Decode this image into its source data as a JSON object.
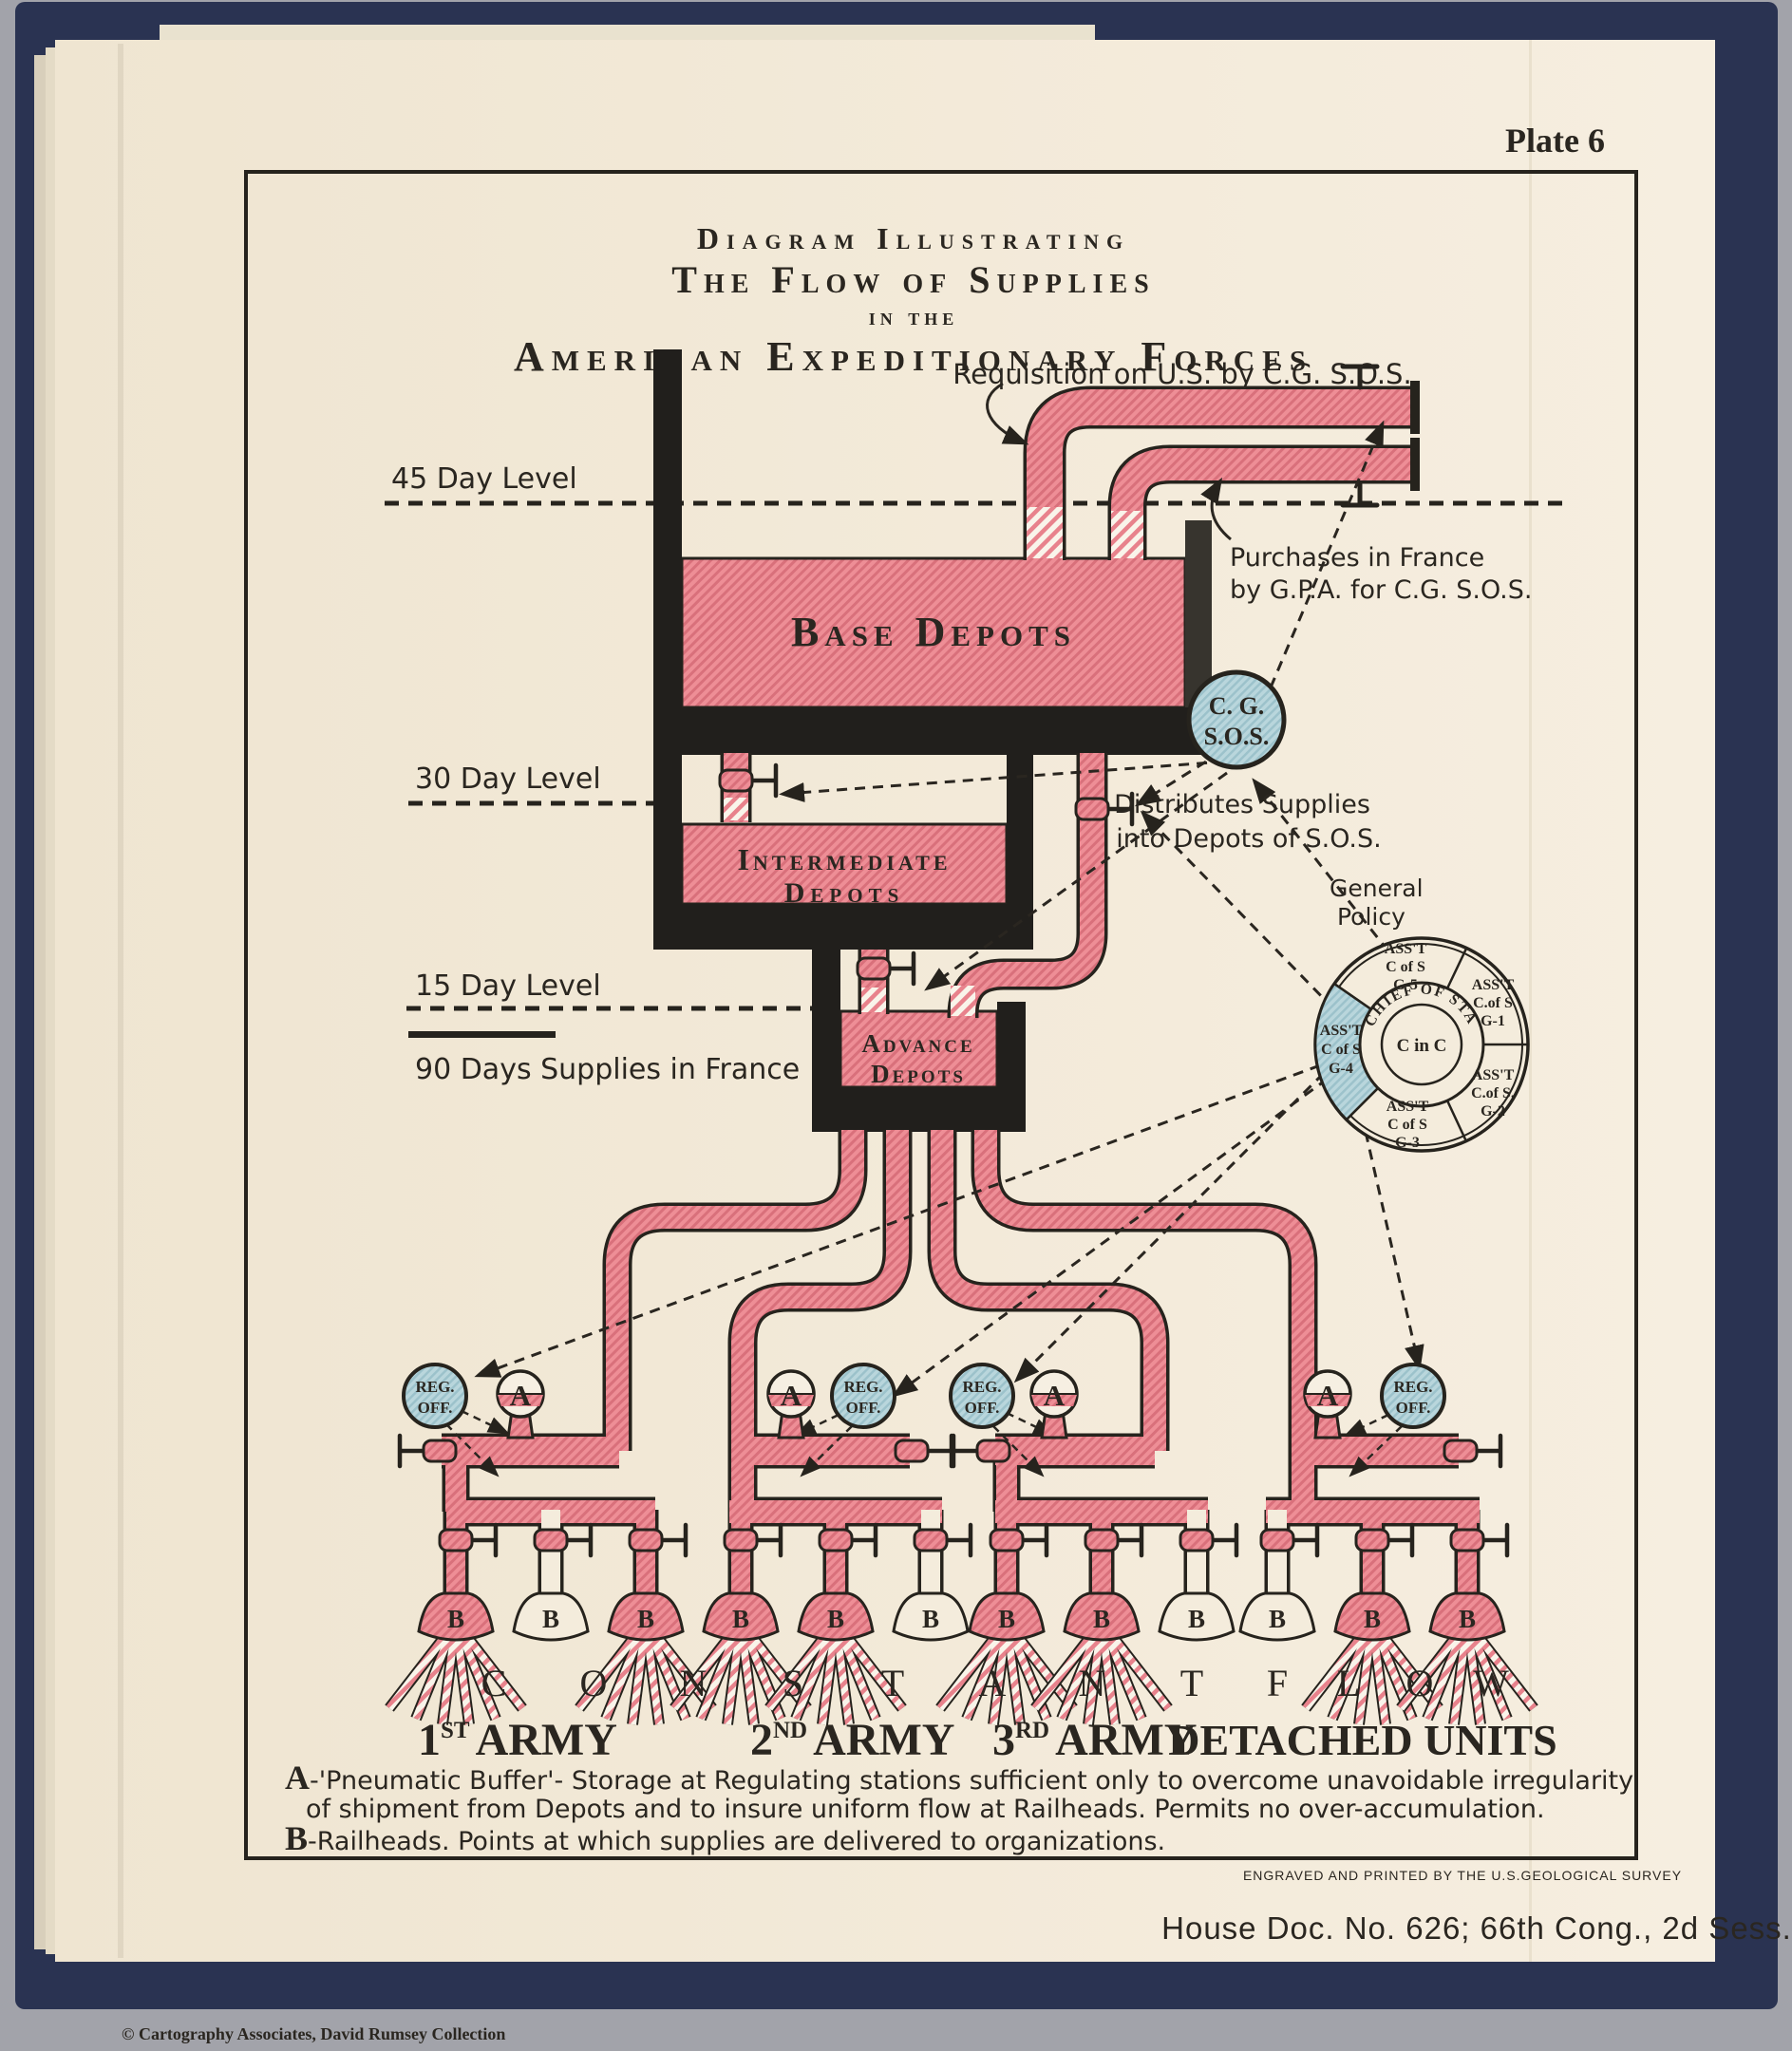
{
  "plate": "Plate 6",
  "title": {
    "line1": "Diagram Illustrating",
    "line2": "The Flow of Supplies",
    "line3": "in the",
    "line4": "American Expeditionary Forces"
  },
  "annotations": {
    "requisition": "Requisition on U.S. by C.G. S.O.S.",
    "purchases_line1": "Purchases in France",
    "purchases_line2": "by G.P.A. for C.G. S.O.S.",
    "level_45": "45 Day Level",
    "level_30": "30 Day Level",
    "level_15": "15 Day Level",
    "supplies_total": "90 Days Supplies in France",
    "distributes_line1": "Distributes Supplies",
    "distributes_line2": "into Depots of S.O.S.",
    "general_policy_line1": "General",
    "general_policy_line2": "Policy"
  },
  "tanks": {
    "base": "Base Depots",
    "intermediate_line1": "Intermediate",
    "intermediate_line2": "Depots",
    "advance_line1": "Advance",
    "advance_line2": "Depots"
  },
  "cg_sos": {
    "line1": "C. G.",
    "line2": "S.O.S."
  },
  "wheel": {
    "ring": "CHIEF OF STAFF",
    "center": "C in C",
    "g5": {
      "l1": "ASS'T",
      "l2": "C of S",
      "l3": "G-5"
    },
    "g1": {
      "l1": "ASS'T",
      "l2": "C.of S",
      "l3": "G-1"
    },
    "g2": {
      "l1": "ASS'T",
      "l2": "C.of S.",
      "l3": "G-2"
    },
    "g3": {
      "l1": "ASS'T",
      "l2": "C of S",
      "l3": "G-3"
    },
    "g4": {
      "l1": "ASS'T",
      "l2": "C of S",
      "l3": "G-4"
    }
  },
  "stations": {
    "reg_line1": "REG.",
    "reg_line2": "OFF.",
    "buffer": "A",
    "railhead": "B"
  },
  "constant_flow": [
    "C",
    "O",
    "N",
    "S",
    "T",
    "A",
    "N",
    "T",
    "F",
    "L",
    "O",
    "W"
  ],
  "armies": {
    "first": {
      "num": "1",
      "sup": "ST",
      "word": "ARMY"
    },
    "second": {
      "num": "2",
      "sup": "ND",
      "word": "ARMY"
    },
    "third": {
      "num": "3",
      "sup": "RD",
      "word": "ARMY"
    },
    "detached": "DETACHED UNITS"
  },
  "legend": {
    "a_letter": "A",
    "a_line1": "-'Pneumatic Buffer'- Storage at Regulating stations sufficient only to overcome unavoidable irregularity",
    "a_line2": "of shipment from Depots and to insure uniform flow at Railheads. Permits no over-accumulation.",
    "b_letter": "B",
    "b_line": "-Railheads.  Points at which supplies are delivered to organizations."
  },
  "footer": {
    "engraved": "ENGRAVED AND PRINTED BY THE U.S.GEOLOGICAL SURVEY",
    "house_doc": "House Doc. No. 626;  66th Cong., 2d Sess.",
    "copyright": "© Cartography Associates, David Rumsey Collection"
  },
  "colors": {
    "pipe_pink": "#ee8e96",
    "pipe_stripe": "#d9707b",
    "station_blue": "#b9d6dc",
    "paper": "#f2e9d8",
    "cover_navy": "#2a3352",
    "ink": "#26231d"
  }
}
